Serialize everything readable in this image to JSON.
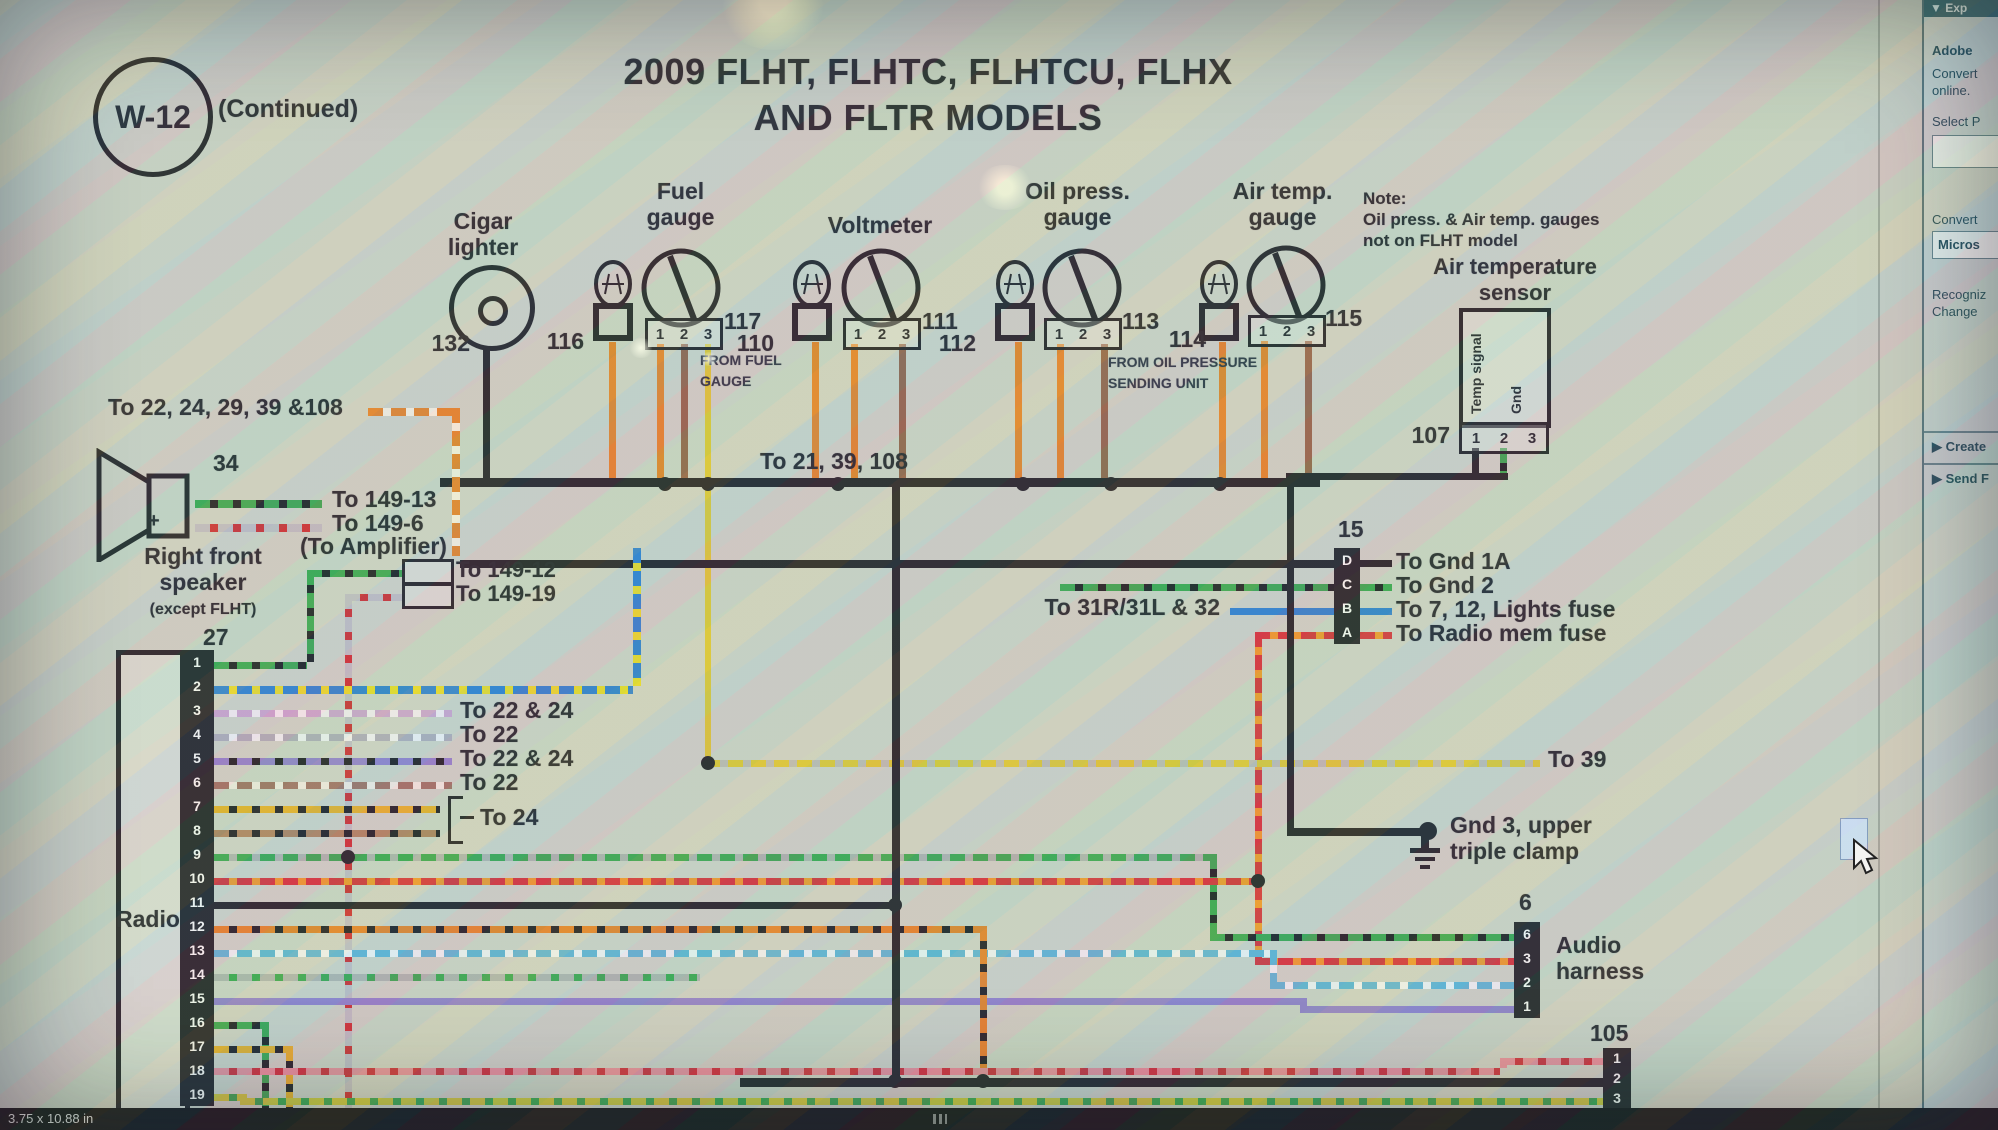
{
  "palette": {
    "wire_orange": "#dd7a1e",
    "wire_green": "#2f9e46",
    "wire_blue": "#2478c8",
    "wire_red": "#cc2830",
    "wire_yellow": "#d6c02a",
    "ink": "#1a1c22",
    "panel_teal": "#2b5c66"
  },
  "icons": {
    "collapse": "▼",
    "expand": "▶"
  },
  "header": {
    "badge": "W-12",
    "continued": "(Continued)",
    "title_line1": "2009 FLHT, FLHTC, FLHTCU, FLHX",
    "title_line2": "AND FLTR MODELS"
  },
  "gauges": {
    "pin_digits": [
      "1",
      "2",
      "3"
    ],
    "cigar": {
      "label_l1": "Cigar",
      "label_l2": "lighter",
      "number": "132"
    },
    "fuel": {
      "label_l1": "Fuel",
      "label_l2": "gauge",
      "bulb": "116",
      "gauge": "117",
      "from_l1": "FROM FUEL",
      "from_l2": "GAUGE"
    },
    "volt": {
      "label": "Voltmeter",
      "bulb": "110",
      "gauge": "111"
    },
    "oil": {
      "label_l1": "Oil press.",
      "label_l2": "gauge",
      "bulb": "112",
      "gauge": "113",
      "from_l1": "FROM OIL PRESSURE",
      "from_l2": "SENDING UNIT"
    },
    "air": {
      "label_l1": "Air temp.",
      "label_l2": "gauge",
      "bulb": "114",
      "gauge": "115"
    },
    "note_l1": "Note:",
    "note_l2": "Oil press. & Air temp. gauges",
    "note_l3": "not on FLHT model",
    "sensor": {
      "label_l1": "Air temperature",
      "label_l2": "sensor",
      "temp_signal": "Temp signal",
      "gnd": "Gnd",
      "number": "107",
      "pins": [
        "1",
        "2",
        "3"
      ]
    }
  },
  "left": {
    "bundle_label": "To 22, 24, 29, 39 &108",
    "speaker_number": "34",
    "speaker_plus": "+",
    "to_149_13": "To 149-13",
    "to_149_6": "To 149-6",
    "to_amplifier": "(To Amplifier)",
    "speaker_l1": "Right front",
    "speaker_l2": "speaker",
    "speaker_l3": "(except FLHT)",
    "to_149_12": "To 149-12",
    "to_149_19": "To 149-19"
  },
  "middle": {
    "bus_label": "To 21, 39, 108",
    "to_31": "To 31R/31L & 32",
    "to_39": "To 39",
    "gnd3_l1": "Gnd 3, upper",
    "gnd3_l2": "triple  clamp"
  },
  "conn15": {
    "number": "15",
    "pins": [
      "D",
      "C",
      "B",
      "A"
    ],
    "labels": [
      "To Gnd 1A",
      "To Gnd 2",
      "To 7, 12, Lights fuse",
      "To Radio mem fuse"
    ]
  },
  "radio": {
    "number": "27",
    "label": "Radio",
    "pins": [
      "1",
      "2",
      "3",
      "4",
      "5",
      "6",
      "7",
      "8",
      "9",
      "10",
      "11",
      "12",
      "13",
      "14",
      "15",
      "16",
      "17",
      "18",
      "19"
    ],
    "wire_label_p3": "To 22 & 24",
    "wire_label_p4": "To 22",
    "wire_label_p5": "To 22 & 24",
    "wire_label_p6": "To 22",
    "wire_label_p78": "To 24"
  },
  "conn6": {
    "number": "6",
    "pins": [
      "6",
      "3",
      "2",
      "1"
    ],
    "label_l1": "Audio",
    "label_l2": "harness"
  },
  "conn105": {
    "number": "105",
    "pins": [
      "1",
      "2",
      "3"
    ]
  },
  "sidebar": {
    "header": "Exp",
    "app": "Adobe",
    "line1": "Convert",
    "line2": "online.",
    "select": "Select P",
    "convert_label": "Convert",
    "convert_value": "Micros",
    "recognize_l1": "Recogniz",
    "recognize_l2": "Change",
    "create": "Create",
    "send": "Send F"
  },
  "statusbar": {
    "size": "3.75 x 10.88 in"
  }
}
